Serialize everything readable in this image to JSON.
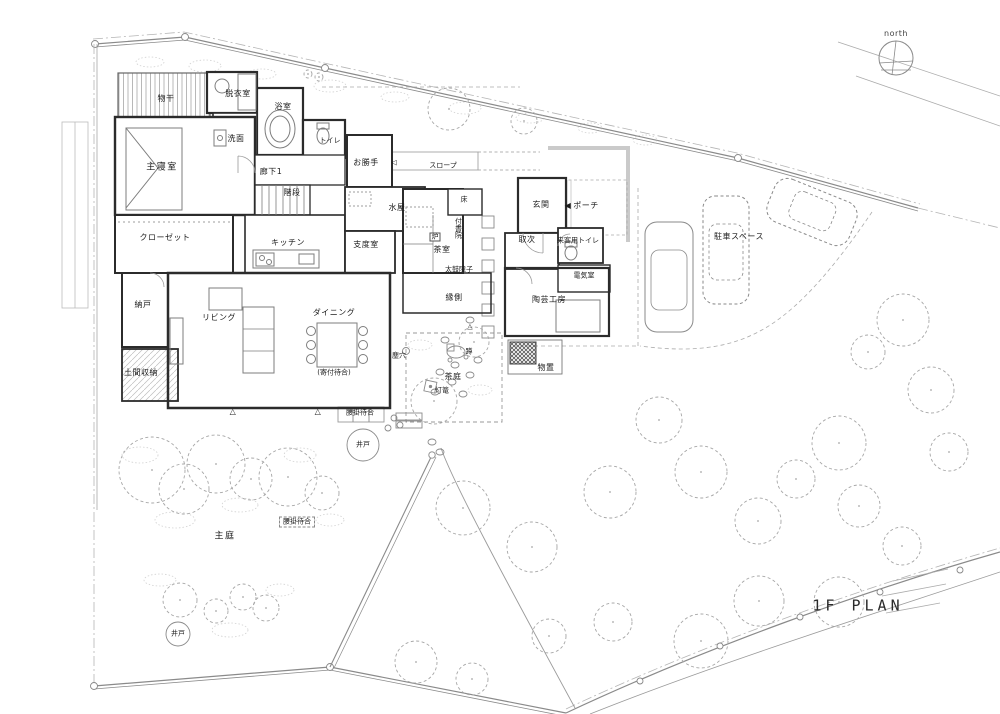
{
  "title": "1F PLAN",
  "colors": {
    "wall": "#2b2b2b",
    "line_light": "#9a9a9a",
    "tree": "#a6a6a6",
    "text": "#1c1c1c",
    "background": "#ffffff"
  },
  "labels": [
    {
      "name": "north-label",
      "text": "north",
      "x": 896,
      "y": 34,
      "cls": "latin tiny"
    },
    {
      "name": "label-monohoshi",
      "text": "物干",
      "x": 166,
      "y": 99,
      "cls": "tiny"
    },
    {
      "name": "label-datsuishitsu",
      "text": "脱衣室",
      "x": 238,
      "y": 94,
      "cls": "tiny"
    },
    {
      "name": "label-yokushitsu",
      "text": "浴室",
      "x": 283,
      "y": 107,
      "cls": "tiny"
    },
    {
      "name": "label-senmen",
      "text": "洗面",
      "x": 236,
      "y": 139,
      "cls": "tiny"
    },
    {
      "name": "label-toilet",
      "text": "トイレ",
      "x": 330,
      "y": 141,
      "cls": "micro"
    },
    {
      "name": "label-shushinshitsu",
      "text": "主寝室",
      "x": 162,
      "y": 168
    },
    {
      "name": "label-rouka1",
      "text": "廊下1",
      "x": 271,
      "y": 172,
      "cls": "tiny"
    },
    {
      "name": "label-kaidan",
      "text": "階段",
      "x": 292,
      "y": 193,
      "cls": "tiny"
    },
    {
      "name": "label-okatte",
      "text": "お勝手",
      "x": 366,
      "y": 163,
      "cls": "tiny"
    },
    {
      "name": "door-arrow-icon",
      "text": "◁",
      "x": 394,
      "y": 163,
      "cls": "micro"
    },
    {
      "name": "label-slope",
      "text": "スロープ",
      "x": 443,
      "y": 166,
      "cls": "micro"
    },
    {
      "name": "label-closet",
      "text": "クローゼット",
      "x": 165,
      "y": 238,
      "cls": "tiny"
    },
    {
      "name": "label-kitchen",
      "text": "キッチン",
      "x": 288,
      "y": 243,
      "cls": "tiny"
    },
    {
      "name": "label-mizuya",
      "text": "水屋",
      "x": 397,
      "y": 208,
      "cls": "tiny"
    },
    {
      "name": "label-toko",
      "text": "床",
      "x": 464,
      "y": 200,
      "cls": "micro"
    },
    {
      "name": "label-tsukeshoin",
      "text": "付書院",
      "x": 458,
      "y": 228,
      "cls": "micro vertical"
    },
    {
      "name": "label-shitakushitsu",
      "text": "支度室",
      "x": 366,
      "y": 245,
      "cls": "tiny"
    },
    {
      "name": "label-ro",
      "text": "炉",
      "x": 435,
      "y": 237,
      "cls": "micro boxed-solid"
    },
    {
      "name": "label-chashitsu",
      "text": "茶室",
      "x": 442,
      "y": 250,
      "cls": "tiny"
    },
    {
      "name": "label-taiko-shoji",
      "text": "太鼓障子",
      "x": 459,
      "y": 270,
      "cls": "micro"
    },
    {
      "name": "label-genkan",
      "text": "玄関",
      "x": 541,
      "y": 205,
      "cls": "tiny"
    },
    {
      "name": "porch-arrow-icon",
      "text": "◀",
      "x": 568,
      "y": 206,
      "cls": "tiny"
    },
    {
      "name": "label-porch",
      "text": "ポーチ",
      "x": 586,
      "y": 206,
      "cls": "tiny"
    },
    {
      "name": "label-toritsugi",
      "text": "取次",
      "x": 527,
      "y": 240,
      "cls": "tiny"
    },
    {
      "name": "label-guest-toilet",
      "text": "来客用トイレ",
      "x": 578,
      "y": 241,
      "cls": "micro"
    },
    {
      "name": "label-denkishitsu",
      "text": "電気室",
      "x": 584,
      "y": 276,
      "cls": "micro"
    },
    {
      "name": "label-nando",
      "text": "納戸",
      "x": 143,
      "y": 305,
      "cls": "tiny"
    },
    {
      "name": "label-living",
      "text": "リビング",
      "x": 219,
      "y": 318,
      "cls": "tiny"
    },
    {
      "name": "label-dining",
      "text": "ダイニング",
      "x": 334,
      "y": 313,
      "cls": "tiny"
    },
    {
      "name": "label-yoritsuki-machiai",
      "text": "(寄付待合)",
      "x": 334,
      "y": 373,
      "cls": "micro"
    },
    {
      "name": "label-doma-shuno",
      "text": "土間収納",
      "x": 141,
      "y": 373,
      "cls": "tiny"
    },
    {
      "name": "label-engawa",
      "text": "縁側",
      "x": 454,
      "y": 298,
      "cls": "tiny"
    },
    {
      "name": "label-tougei-kobo",
      "text": "陶芸工房",
      "x": 549,
      "y": 300,
      "cls": "tiny"
    },
    {
      "name": "label-monooki",
      "text": "物置",
      "x": 546,
      "y": 368,
      "cls": "tiny"
    },
    {
      "name": "label-chiriana",
      "text": "塵穴",
      "x": 399,
      "y": 356,
      "cls": "micro"
    },
    {
      "name": "label-tsukubai",
      "text": "蹲",
      "x": 469,
      "y": 352,
      "cls": "micro"
    },
    {
      "name": "label-chatei",
      "text": "茶庭",
      "x": 453,
      "y": 377,
      "cls": "tiny"
    },
    {
      "name": "label-toro",
      "text": "灯篭",
      "x": 442,
      "y": 391,
      "cls": "micro"
    },
    {
      "name": "label-parking-space",
      "text": "駐車スペース",
      "x": 739,
      "y": 237,
      "cls": "tiny"
    },
    {
      "name": "label-koshikake-machiai-1",
      "text": "腰掛待合",
      "x": 360,
      "y": 413,
      "cls": "micro"
    },
    {
      "name": "label-ido-1",
      "text": "井戸",
      "x": 363,
      "y": 445,
      "cls": "micro"
    },
    {
      "name": "label-koshikake-machiai-2",
      "text": "腰掛待合",
      "x": 297,
      "y": 522,
      "cls": "micro boxed"
    },
    {
      "name": "label-shutei",
      "text": "主庭",
      "x": 225,
      "y": 537
    },
    {
      "name": "label-ido-2",
      "text": "井戸",
      "x": 178,
      "y": 634,
      "cls": "micro"
    },
    {
      "name": "triangle-marker-1",
      "text": "△",
      "x": 233,
      "y": 412,
      "cls": "tiny"
    },
    {
      "name": "triangle-marker-2",
      "text": "△",
      "x": 318,
      "y": 412,
      "cls": "tiny"
    },
    {
      "name": "triangle-marker-3",
      "text": "△",
      "x": 470,
      "y": 327,
      "cls": "micro"
    },
    {
      "name": "plan-title",
      "text": "1F PLAN",
      "x": 858,
      "y": 606,
      "cls": "title latin"
    }
  ],
  "trees": [
    [
      152,
      470,
      33
    ],
    [
      184,
      489,
      25
    ],
    [
      216,
      464,
      29
    ],
    [
      251,
      479,
      21
    ],
    [
      288,
      477,
      29
    ],
    [
      322,
      493,
      17
    ],
    [
      180,
      600,
      17
    ],
    [
      216,
      611,
      12
    ],
    [
      243,
      597,
      13
    ],
    [
      266,
      608,
      13
    ],
    [
      434,
      401,
      23
    ],
    [
      474,
      342,
      15
    ],
    [
      449,
      109,
      21
    ],
    [
      524,
      121,
      13
    ],
    [
      308,
      74,
      4
    ],
    [
      319,
      77,
      4
    ],
    [
      463,
      508,
      27
    ],
    [
      532,
      547,
      25
    ],
    [
      610,
      492,
      26
    ],
    [
      659,
      420,
      23
    ],
    [
      701,
      472,
      26
    ],
    [
      758,
      521,
      23
    ],
    [
      796,
      479,
      19
    ],
    [
      839,
      443,
      27
    ],
    [
      859,
      506,
      21
    ],
    [
      903,
      320,
      26
    ],
    [
      868,
      352,
      17
    ],
    [
      931,
      390,
      23
    ],
    [
      949,
      452,
      19
    ],
    [
      701,
      641,
      27
    ],
    [
      759,
      601,
      25
    ],
    [
      613,
      622,
      19
    ],
    [
      549,
      636,
      17
    ],
    [
      416,
      662,
      21
    ],
    [
      472,
      679,
      16
    ],
    [
      839,
      602,
      25
    ],
    [
      902,
      546,
      19
    ]
  ]
}
